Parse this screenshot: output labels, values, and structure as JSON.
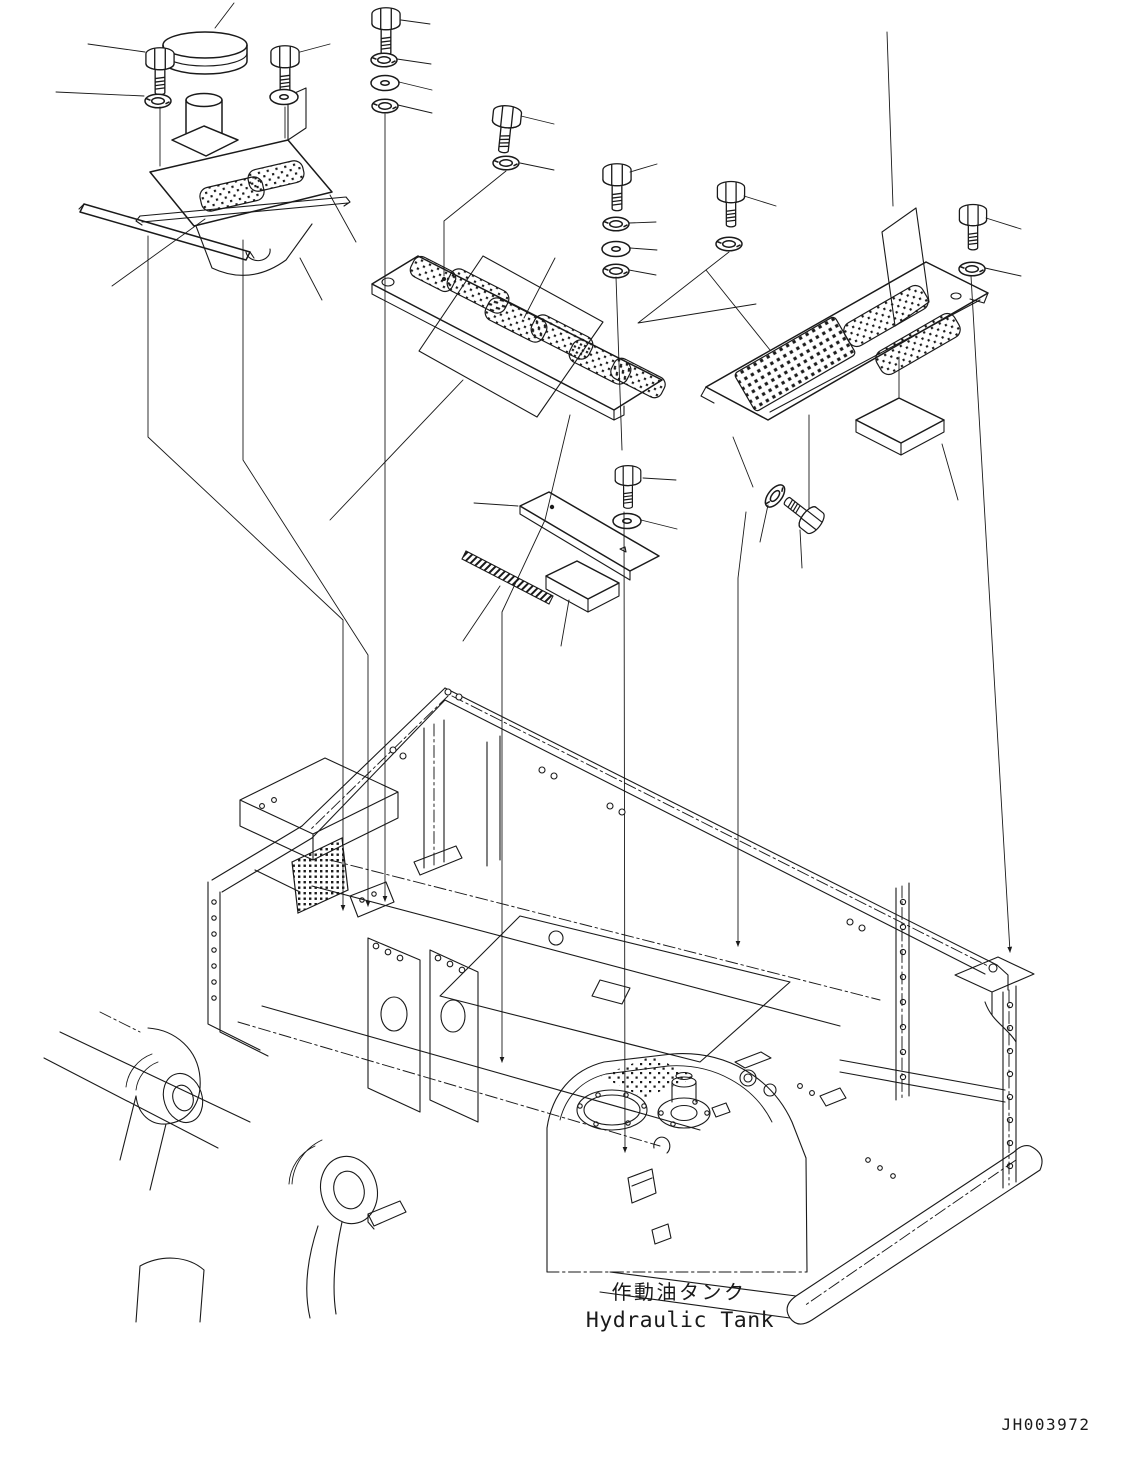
{
  "page": {
    "background": "#ffffff",
    "line_color": "#1a1a1a"
  },
  "labels": {
    "tank_label_jp": "作動油タンク",
    "tank_label_en": "Hydraulic Tank",
    "drawing_number": "JH003972"
  },
  "diagram": {
    "type": "exploded-parts-drawing",
    "subject": "hydraulic tank cover assembly on excavator revolving frame",
    "parts": [
      {
        "name": "hex-bolt",
        "qty": 9
      },
      {
        "name": "spring-washer",
        "qty": 8
      },
      {
        "name": "flat-washer",
        "qty": 5
      },
      {
        "name": "breather-cap",
        "qty": 1
      },
      {
        "name": "oil-filler-cover-assembly",
        "qty": 1
      },
      {
        "name": "seal-strip",
        "qty": 2
      },
      {
        "name": "center-cover-plate",
        "qty": 1
      },
      {
        "name": "right-cover-plate",
        "qty": 1
      },
      {
        "name": "small-cover-plate",
        "qty": 1
      },
      {
        "name": "anti-slip-pad",
        "qty": 10
      },
      {
        "name": "protective-sheet",
        "qty": 2
      },
      {
        "name": "sponge-pad",
        "qty": 2
      },
      {
        "name": "perforated-grille",
        "qty": 1
      },
      {
        "name": "revolving-frame",
        "qty": 1
      },
      {
        "name": "hydraulic-tank",
        "qty": 1
      },
      {
        "name": "boom-mounting-bracket",
        "qty": 2
      }
    ]
  }
}
